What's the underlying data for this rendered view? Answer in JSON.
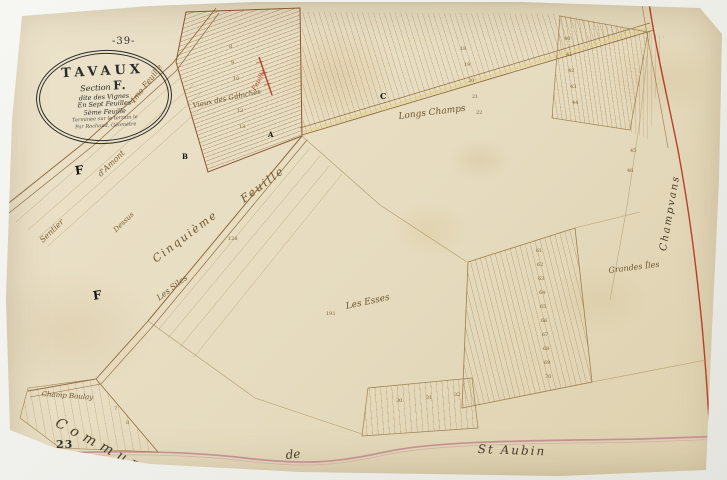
{
  "map": {
    "page_number_top": "-39-",
    "page_number_bottom": "23",
    "cartouche": {
      "title": "TAVAUX",
      "section_label": "Section",
      "section_letter": "F.",
      "line_dite": "dite des Vignes",
      "line_feuilles": "En Sept Feuilles",
      "line_sheet": "5ème Feuille",
      "line_small1": "Terminée sur le terrain le",
      "line_small2": "Par Rochaud, Géomètre"
    },
    "colors": {
      "paper": "#e9dfc6",
      "ink_brown": "#8f6b3e",
      "red_boundary": "#b5402e",
      "pink_boundary": "#c08a90",
      "yellow_road": "#e3cf7e"
    },
    "labels": [
      {
        "text": "4me Feuille",
        "x": 128,
        "y": 100,
        "rot": -52,
        "size": 8,
        "kind": "kind-road"
      },
      {
        "text": "Feuille",
        "x": 250,
        "y": 88,
        "rot": -62,
        "size": 6.5,
        "kind": "kind-red"
      },
      {
        "text": "Cinquième",
        "x": 150,
        "y": 255,
        "rot": -37,
        "size": 11,
        "kind": "kind-road-big"
      },
      {
        "text": "Feuille",
        "x": 238,
        "y": 195,
        "rot": -37,
        "size": 11,
        "kind": "kind-road-big"
      },
      {
        "text": "Sentier",
        "x": 38,
        "y": 238,
        "rot": -44,
        "size": 8,
        "kind": "kind-road"
      },
      {
        "text": "d'Amont",
        "x": 96,
        "y": 172,
        "rot": -44,
        "size": 8,
        "kind": "kind-road"
      },
      {
        "text": "Dessus",
        "x": 112,
        "y": 228,
        "rot": -44,
        "size": 7,
        "kind": "kind-road"
      },
      {
        "text": "Vieux des Guinches",
        "x": 192,
        "y": 102,
        "rot": -12,
        "size": 7,
        "kind": "kind-place"
      },
      {
        "text": "Longs Champs",
        "x": 398,
        "y": 112,
        "rot": -7,
        "size": 9,
        "kind": "kind-place"
      },
      {
        "text": "Les Esses",
        "x": 345,
        "y": 302,
        "rot": -12,
        "size": 9,
        "kind": "kind-place"
      },
      {
        "text": "Les Siles",
        "x": 155,
        "y": 295,
        "rot": -37,
        "size": 8,
        "kind": "kind-place"
      },
      {
        "text": "Grandes Îles",
        "x": 608,
        "y": 266,
        "rot": -7,
        "size": 8,
        "kind": "kind-place"
      },
      {
        "text": "Champ Boulay",
        "x": 42,
        "y": 390,
        "rot": 4,
        "size": 7,
        "kind": "kind-place"
      },
      {
        "text": "Commune",
        "x": 60,
        "y": 415,
        "rot": 28,
        "size": 14,
        "ls": 6,
        "kind": "kind-boundary-big"
      },
      {
        "text": "de",
        "x": 285,
        "y": 448,
        "rot": -5,
        "size": 12,
        "kind": "kind-boundary-big"
      },
      {
        "text": "St Aubin",
        "x": 478,
        "y": 442,
        "rot": 2,
        "size": 12,
        "ls": 2,
        "kind": "kind-boundary-big"
      },
      {
        "text": "Champvans",
        "x": 658,
        "y": 250,
        "rot": -80,
        "size": 10,
        "ls": 2,
        "kind": "kind-boundary-big"
      },
      {
        "text": "A",
        "x": 268,
        "y": 130,
        "rot": 0,
        "size": 7,
        "kind": "kind-letter"
      },
      {
        "text": "B",
        "x": 182,
        "y": 152,
        "rot": 0,
        "size": 7,
        "kind": "kind-letter"
      },
      {
        "text": "C",
        "x": 380,
        "y": 91,
        "rot": 0,
        "size": 8,
        "kind": "kind-letter"
      },
      {
        "text": "F",
        "x": 74,
        "y": 164,
        "rot": -8,
        "size": 12,
        "kind": "kind-letter"
      },
      {
        "text": "F",
        "x": 92,
        "y": 289,
        "rot": -8,
        "size": 12,
        "kind": "kind-letter"
      }
    ],
    "parcel_numbers": [
      {
        "t": "8",
        "x": 229,
        "y": 44
      },
      {
        "t": "9",
        "x": 231,
        "y": 60
      },
      {
        "t": "10",
        "x": 233,
        "y": 76
      },
      {
        "t": "11",
        "x": 235,
        "y": 92
      },
      {
        "t": "12",
        "x": 237,
        "y": 108
      },
      {
        "t": "13",
        "x": 239,
        "y": 124
      },
      {
        "t": "18",
        "x": 460,
        "y": 46
      },
      {
        "t": "19",
        "x": 464,
        "y": 62
      },
      {
        "t": "20",
        "x": 468,
        "y": 78
      },
      {
        "t": "21",
        "x": 472,
        "y": 94
      },
      {
        "t": "22",
        "x": 476,
        "y": 110
      },
      {
        "t": "40",
        "x": 564,
        "y": 36
      },
      {
        "t": "41",
        "x": 566,
        "y": 52
      },
      {
        "t": "42",
        "x": 568,
        "y": 68
      },
      {
        "t": "43",
        "x": 570,
        "y": 84
      },
      {
        "t": "44",
        "x": 572,
        "y": 100
      },
      {
        "t": "45",
        "x": 630,
        "y": 148
      },
      {
        "t": "46",
        "x": 627,
        "y": 168
      },
      {
        "t": "61",
        "x": 536,
        "y": 248
      },
      {
        "t": "62",
        "x": 537,
        "y": 262
      },
      {
        "t": "63",
        "x": 538,
        "y": 276
      },
      {
        "t": "64",
        "x": 539,
        "y": 290
      },
      {
        "t": "65",
        "x": 540,
        "y": 304
      },
      {
        "t": "66",
        "x": 541,
        "y": 318
      },
      {
        "t": "67",
        "x": 542,
        "y": 332
      },
      {
        "t": "68",
        "x": 543,
        "y": 346
      },
      {
        "t": "69",
        "x": 544,
        "y": 360
      },
      {
        "t": "70",
        "x": 545,
        "y": 374
      },
      {
        "t": "30",
        "x": 396,
        "y": 398
      },
      {
        "t": "31",
        "x": 426,
        "y": 395
      },
      {
        "t": "32",
        "x": 454,
        "y": 392
      },
      {
        "t": "7",
        "x": 114,
        "y": 406
      },
      {
        "t": "8",
        "x": 126,
        "y": 420
      },
      {
        "t": "191",
        "x": 326,
        "y": 311
      },
      {
        "t": "128",
        "x": 228,
        "y": 236
      },
      {
        "t": "1",
        "x": 649,
        "y": 8
      }
    ]
  }
}
